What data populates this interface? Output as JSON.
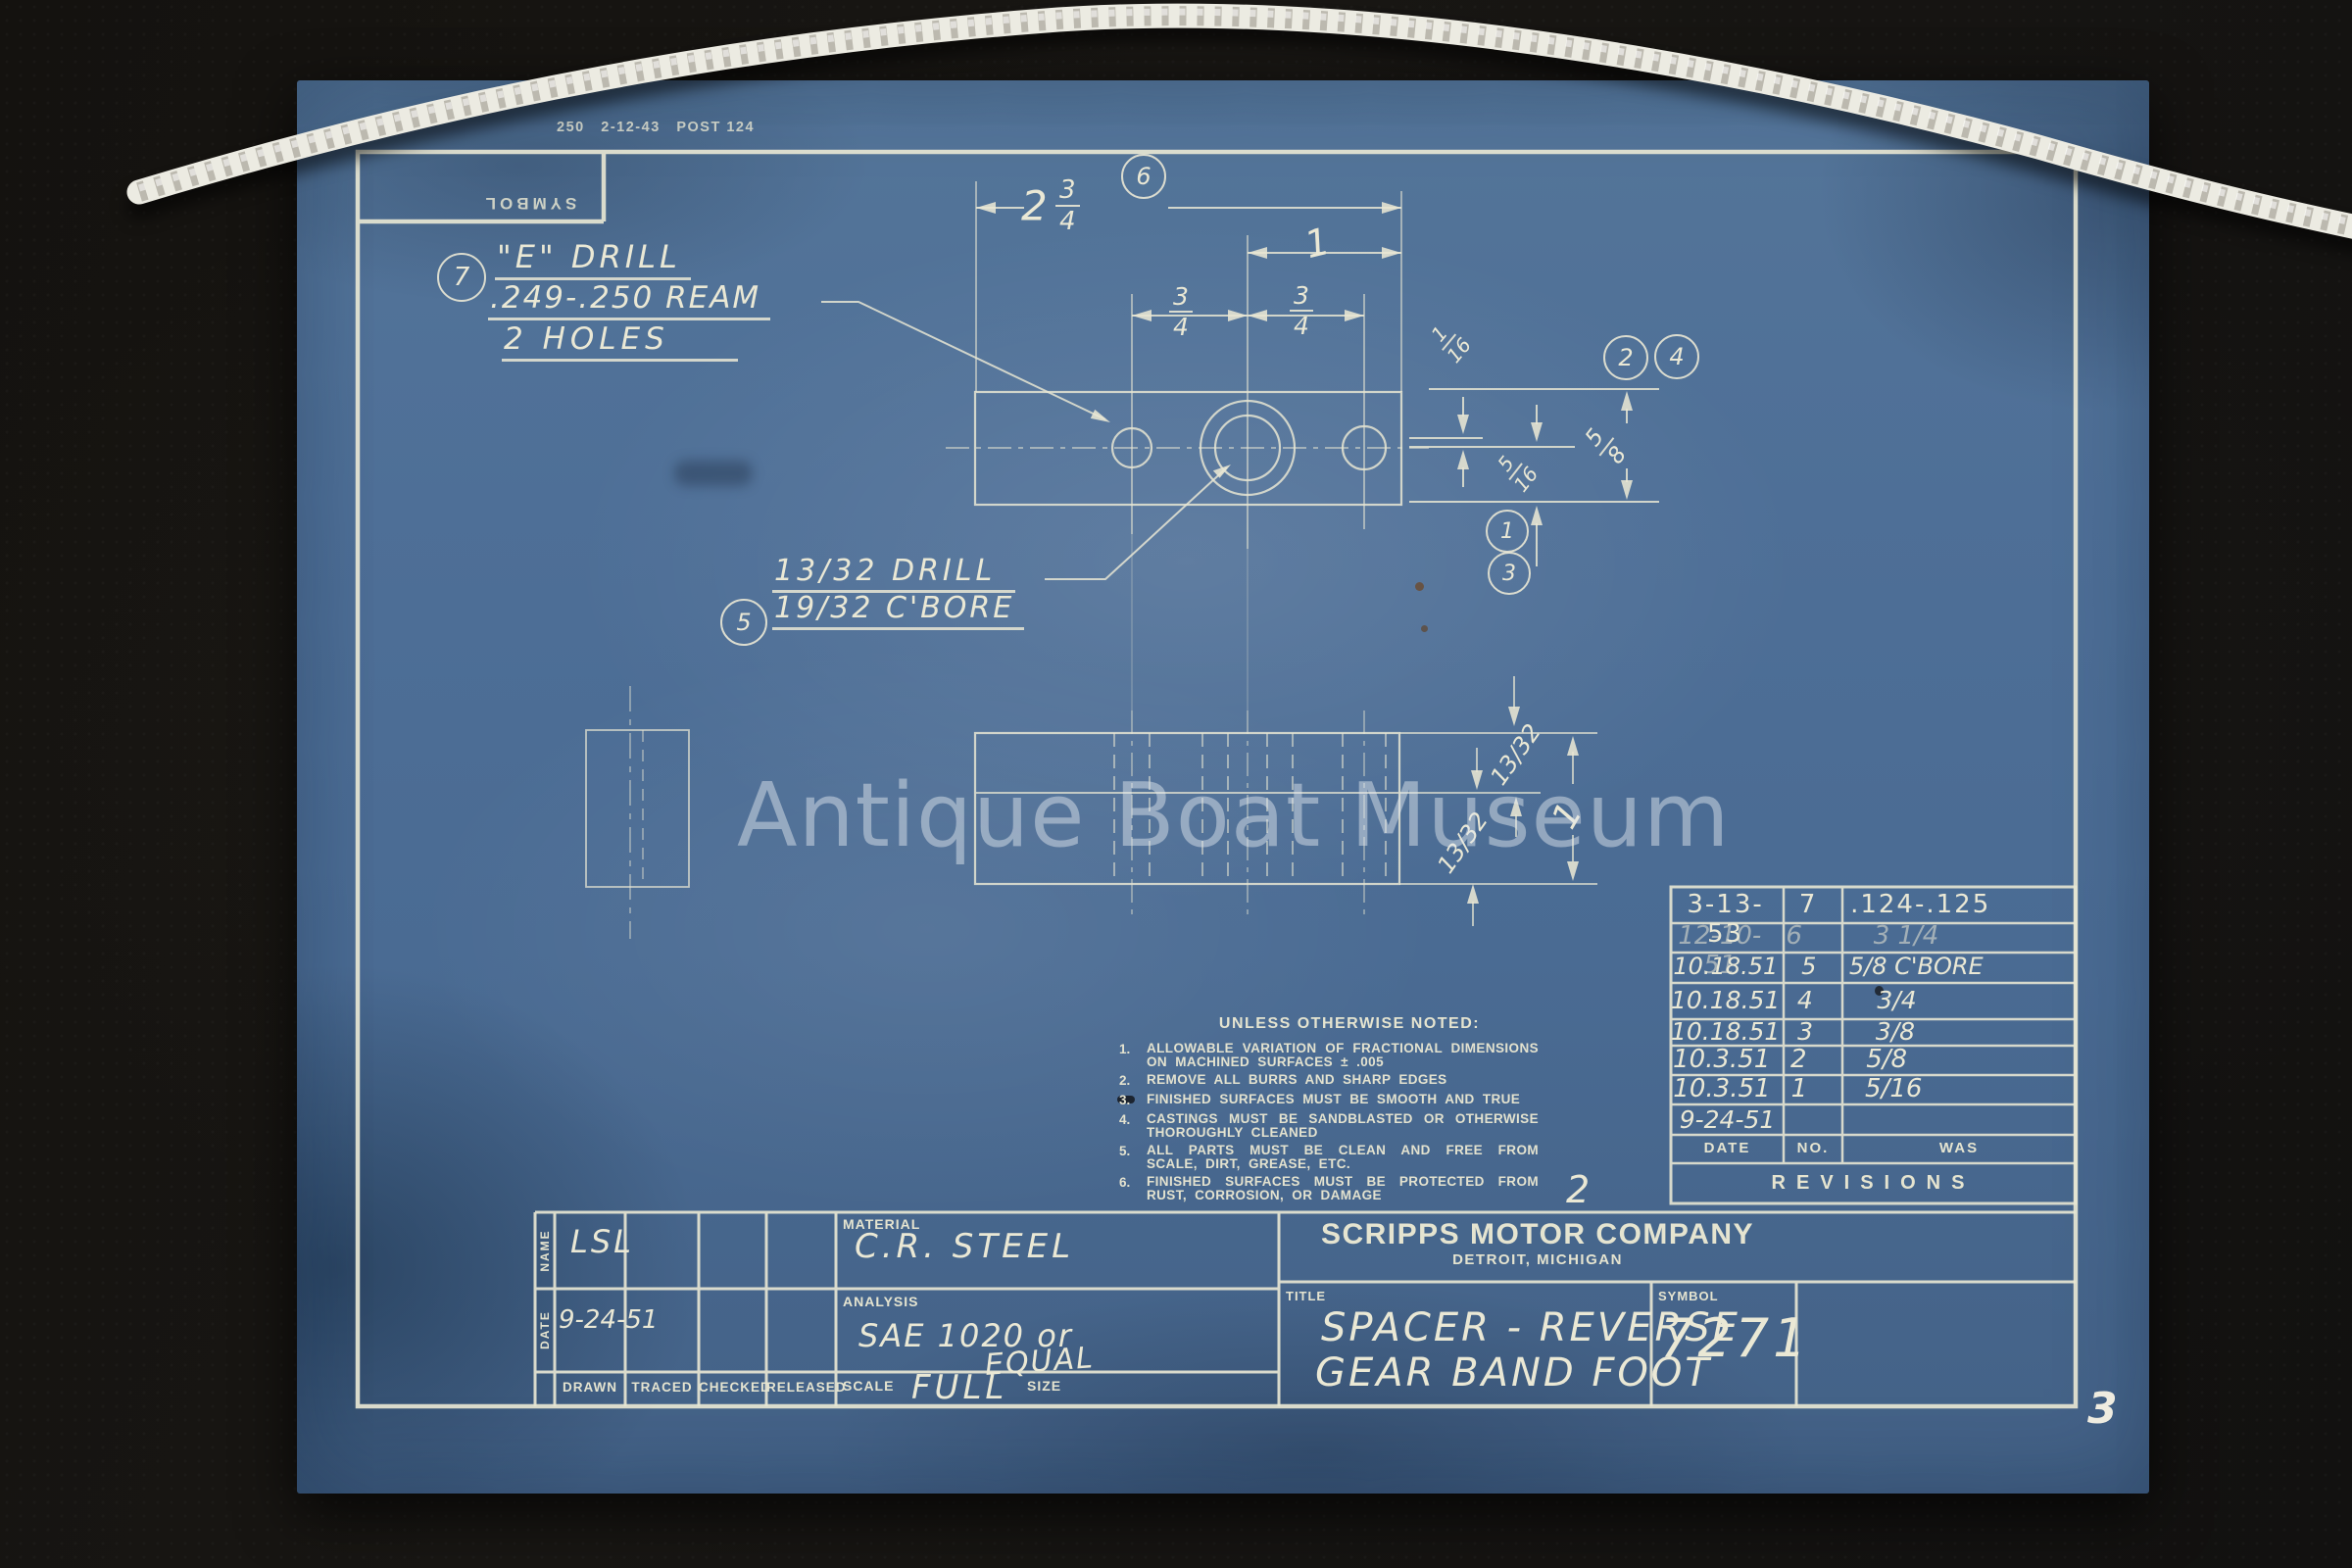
{
  "photo": {
    "watermark": "Antique Boat Museum",
    "page_number": "3"
  },
  "sheet_margins": {
    "print_stamp": "250   2-12-43   POST 124",
    "symbol_box_label": "SYMBOL",
    "revision_margin_mark": "2"
  },
  "callouts": {
    "c1": "1",
    "c2": "2",
    "c3": "3",
    "c4": "4",
    "c5": "5",
    "c6": "6",
    "c7": "7"
  },
  "annotations": {
    "e_drill_line1": "\"E\" DRILL",
    "e_drill_line2": ".249-.250 REAM",
    "e_drill_line3": "2 HOLES",
    "bore_line1": "13/32 DRILL",
    "bore_line2": "19/32 C'BORE"
  },
  "dimensions": {
    "overall_whole": "2",
    "overall_num": "3",
    "overall_den": "4",
    "center_to_end": "1",
    "left_num": "3",
    "left_den": "4",
    "right_num": "3",
    "right_den": "4",
    "lip_num": "1",
    "lip_den": "16",
    "step_num": "5",
    "step_den": "16",
    "height_num": "5",
    "height_den": "8",
    "side_upper": "13/32",
    "side_lower": "13/32",
    "side_overall": "1"
  },
  "general_notes": {
    "title": "UNLESS OTHERWISE NOTED:",
    "items": [
      {
        "no": "1.",
        "text": "ALLOWABLE VARIATION OF FRACTIONAL DIMENSIONS ON MACHINED SURFACES ± .005"
      },
      {
        "no": "2.",
        "text": "REMOVE ALL BURRS AND SHARP EDGES"
      },
      {
        "no": "3.",
        "text": "FINISHED SURFACES MUST BE SMOOTH AND TRUE"
      },
      {
        "no": "4.",
        "text": "CASTINGS MUST BE SANDBLASTED OR OTHERWISE THOROUGHLY CLEANED"
      },
      {
        "no": "5.",
        "text": "ALL PARTS MUST BE CLEAN AND FREE FROM SCALE, DIRT, GREASE, ETC."
      },
      {
        "no": "6.",
        "text": "FINISHED SURFACES MUST BE PROTECTED FROM RUST, CORROSION, OR DAMAGE"
      }
    ]
  },
  "revisions": {
    "title": "REVISIONS",
    "headers": {
      "date": "DATE",
      "no": "NO.",
      "was": "WAS"
    },
    "rows": [
      {
        "date": "3-13-53",
        "no": "7",
        "was": ".124-.125"
      },
      {
        "date": "12-10-51",
        "no": "6",
        "was": "3 1/4"
      },
      {
        "date": "10.18.51",
        "no": "5",
        "was": "5/8 C'BORE"
      },
      {
        "date": "10.18.51",
        "no": "4",
        "was": "3/4"
      },
      {
        "date": "10.18.51",
        "no": "3",
        "was": "3/8"
      },
      {
        "date": "10.3.51",
        "no": "2",
        "was": "5/8"
      },
      {
        "date": "10.3.51",
        "no": "1",
        "was": "5/16"
      },
      {
        "date": "9-24-51",
        "no": "",
        "was": ""
      }
    ]
  },
  "title_block": {
    "name_label": "NAME",
    "name_value": "LSL",
    "date_label": "DATE",
    "date_value": "9-24-51",
    "drawn_label": "DRAWN",
    "traced_label": "TRACED",
    "checked_label": "CHECKED",
    "released_label": "RELEASED",
    "material_label": "MATERIAL",
    "material_value": "C.R. STEEL",
    "analysis_label": "ANALYSIS",
    "analysis_value_1": "SAE 1020 or",
    "analysis_value_2": "EQUAL",
    "scale_label": "SCALE",
    "scale_value": "FULL",
    "size_label": "SIZE",
    "company_name": "SCRIPPS MOTOR COMPANY",
    "company_location": "DETROIT, MICHIGAN",
    "title_label": "TITLE",
    "title_value_1": "SPACER - REVERSE",
    "title_value_2": "GEAR BAND FOOT",
    "symbol_label": "SYMBOL",
    "symbol_value": "7271"
  }
}
